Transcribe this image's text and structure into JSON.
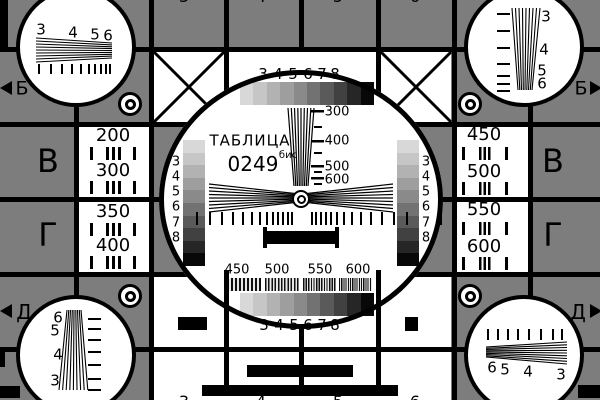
{
  "colors": {
    "background_gray": "#7d7d7d",
    "line_black": "#000000",
    "panel_white": "#ffffff"
  },
  "card": {
    "title": "ТАБЛИЦА",
    "number": "0249",
    "number_suffix": "бис"
  },
  "grayscale_steps": [
    "#d8d8d8",
    "#c6c6c6",
    "#b2b2b2",
    "#9e9e9e",
    "#8a8a8a",
    "#727272",
    "#5a5a5a",
    "#414141",
    "#262626",
    "#080808"
  ],
  "top_grayscale_labels": [
    "3",
    "4",
    "5",
    "6",
    "7",
    "8"
  ],
  "bottom_grayscale_labels": [
    "3",
    "4",
    "5",
    "6",
    "7",
    "8"
  ],
  "left_graybar_labels": [
    "3",
    "4",
    "5",
    "6",
    "7",
    "8"
  ],
  "right_graybar_labels": [
    "3",
    "4",
    "5",
    "6",
    "7",
    "8"
  ],
  "wedge_scale_labels": [
    "300",
    "400",
    "500",
    "600"
  ],
  "burst_labels": [
    "450",
    "500",
    "550",
    "600"
  ],
  "resolution_boxes": {
    "left": [
      "200",
      "300",
      "350",
      "400"
    ],
    "right": [
      "450",
      "500",
      "550",
      "600"
    ]
  },
  "corner_wedges": {
    "top_left": [
      "3",
      "4",
      "5",
      "6"
    ],
    "top_right": [
      "3",
      "4",
      "5",
      "6"
    ],
    "bottom_left": [
      "6",
      "5",
      "4",
      "3"
    ],
    "bottom_right": [
      "6",
      "5",
      "4",
      "3"
    ]
  },
  "edge_markers": {
    "left": [
      "Б",
      "В",
      "Г",
      "Д"
    ],
    "right": [
      "Б",
      "В",
      "Г",
      "Д"
    ]
  },
  "edge_digits_top": [
    "3",
    "4",
    "5",
    "6"
  ],
  "edge_digits_bottom": [
    "3",
    "4",
    "5",
    "6"
  ]
}
